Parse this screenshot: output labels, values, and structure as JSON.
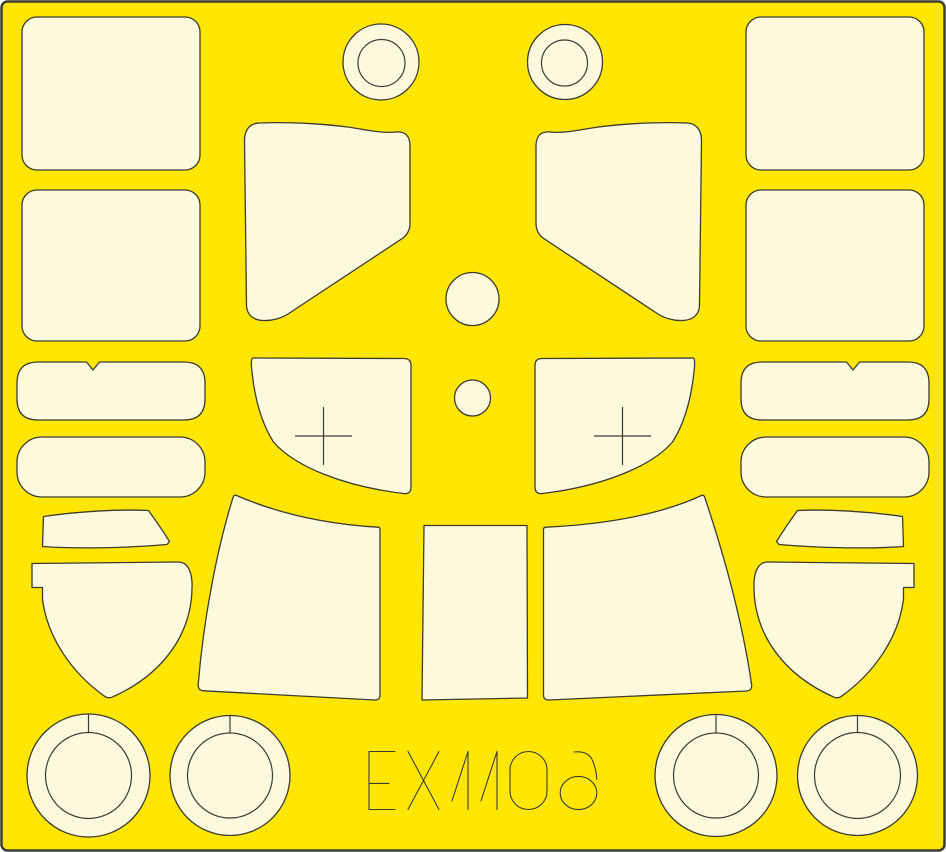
{
  "sheet": {
    "code": "EX1106",
    "colors": {
      "background": "#ffe605",
      "mask_fill": "#fcf9dc",
      "outline": "#3d3c32"
    },
    "mask_groups": [
      {
        "name": "rounded-panel-mask",
        "count": 4
      },
      {
        "name": "ring-mask-top",
        "count": 2
      },
      {
        "name": "windshield-quarter-mask",
        "count": 2
      },
      {
        "name": "round-dot-mask",
        "count": 2
      },
      {
        "name": "crosshair-canopy-mask",
        "count": 2
      },
      {
        "name": "notched-pill-mask",
        "count": 2
      },
      {
        "name": "plain-pill-mask",
        "count": 2
      },
      {
        "name": "visor-band-mask",
        "count": 2
      },
      {
        "name": "shield-mask",
        "count": 2
      },
      {
        "name": "canopy-side-mask",
        "count": 2
      },
      {
        "name": "canopy-center-mask",
        "count": 1
      },
      {
        "name": "wheel-hub-ring-mask",
        "count": 4
      }
    ]
  }
}
